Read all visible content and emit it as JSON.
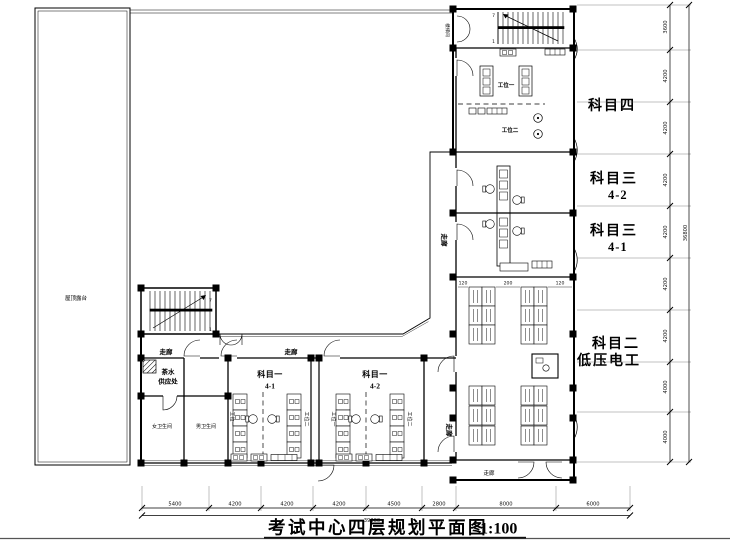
{
  "title": {
    "text": "考试中心四层规划平面图",
    "scale": "1:100"
  },
  "rooms": {
    "roof_terrace": "屋顶露台",
    "subject4": "科目四",
    "subject3": "科目三",
    "s3_r2": "4-2",
    "s3_r1": "4-1",
    "subject2_line1": "科目二",
    "subject2_line2": "低压电工",
    "subject1": "科目一",
    "s1_r1": "4-1",
    "s1_r2": "4-2",
    "tea1": "茶水",
    "tea2": "供应处",
    "toilet_f": "女卫生间",
    "toilet_m": "男卫生间",
    "corridor": "走廊",
    "stairwell": "楼梯间",
    "station1": "工位一",
    "station2": "工位二"
  },
  "stairs": {
    "top": "7",
    "bottom": "1"
  },
  "dims": {
    "bottom": [
      "5400",
      "4200",
      "4200",
      "4200",
      "4500",
      "2800",
      "8000",
      "6000"
    ],
    "bottom_total": "39300",
    "right": [
      "3600",
      "4200",
      "4200",
      "4200",
      "4200",
      "4200",
      "4200",
      "4000",
      "4000"
    ],
    "right_total": "36800",
    "inner": [
      "120",
      "200",
      "120"
    ]
  }
}
